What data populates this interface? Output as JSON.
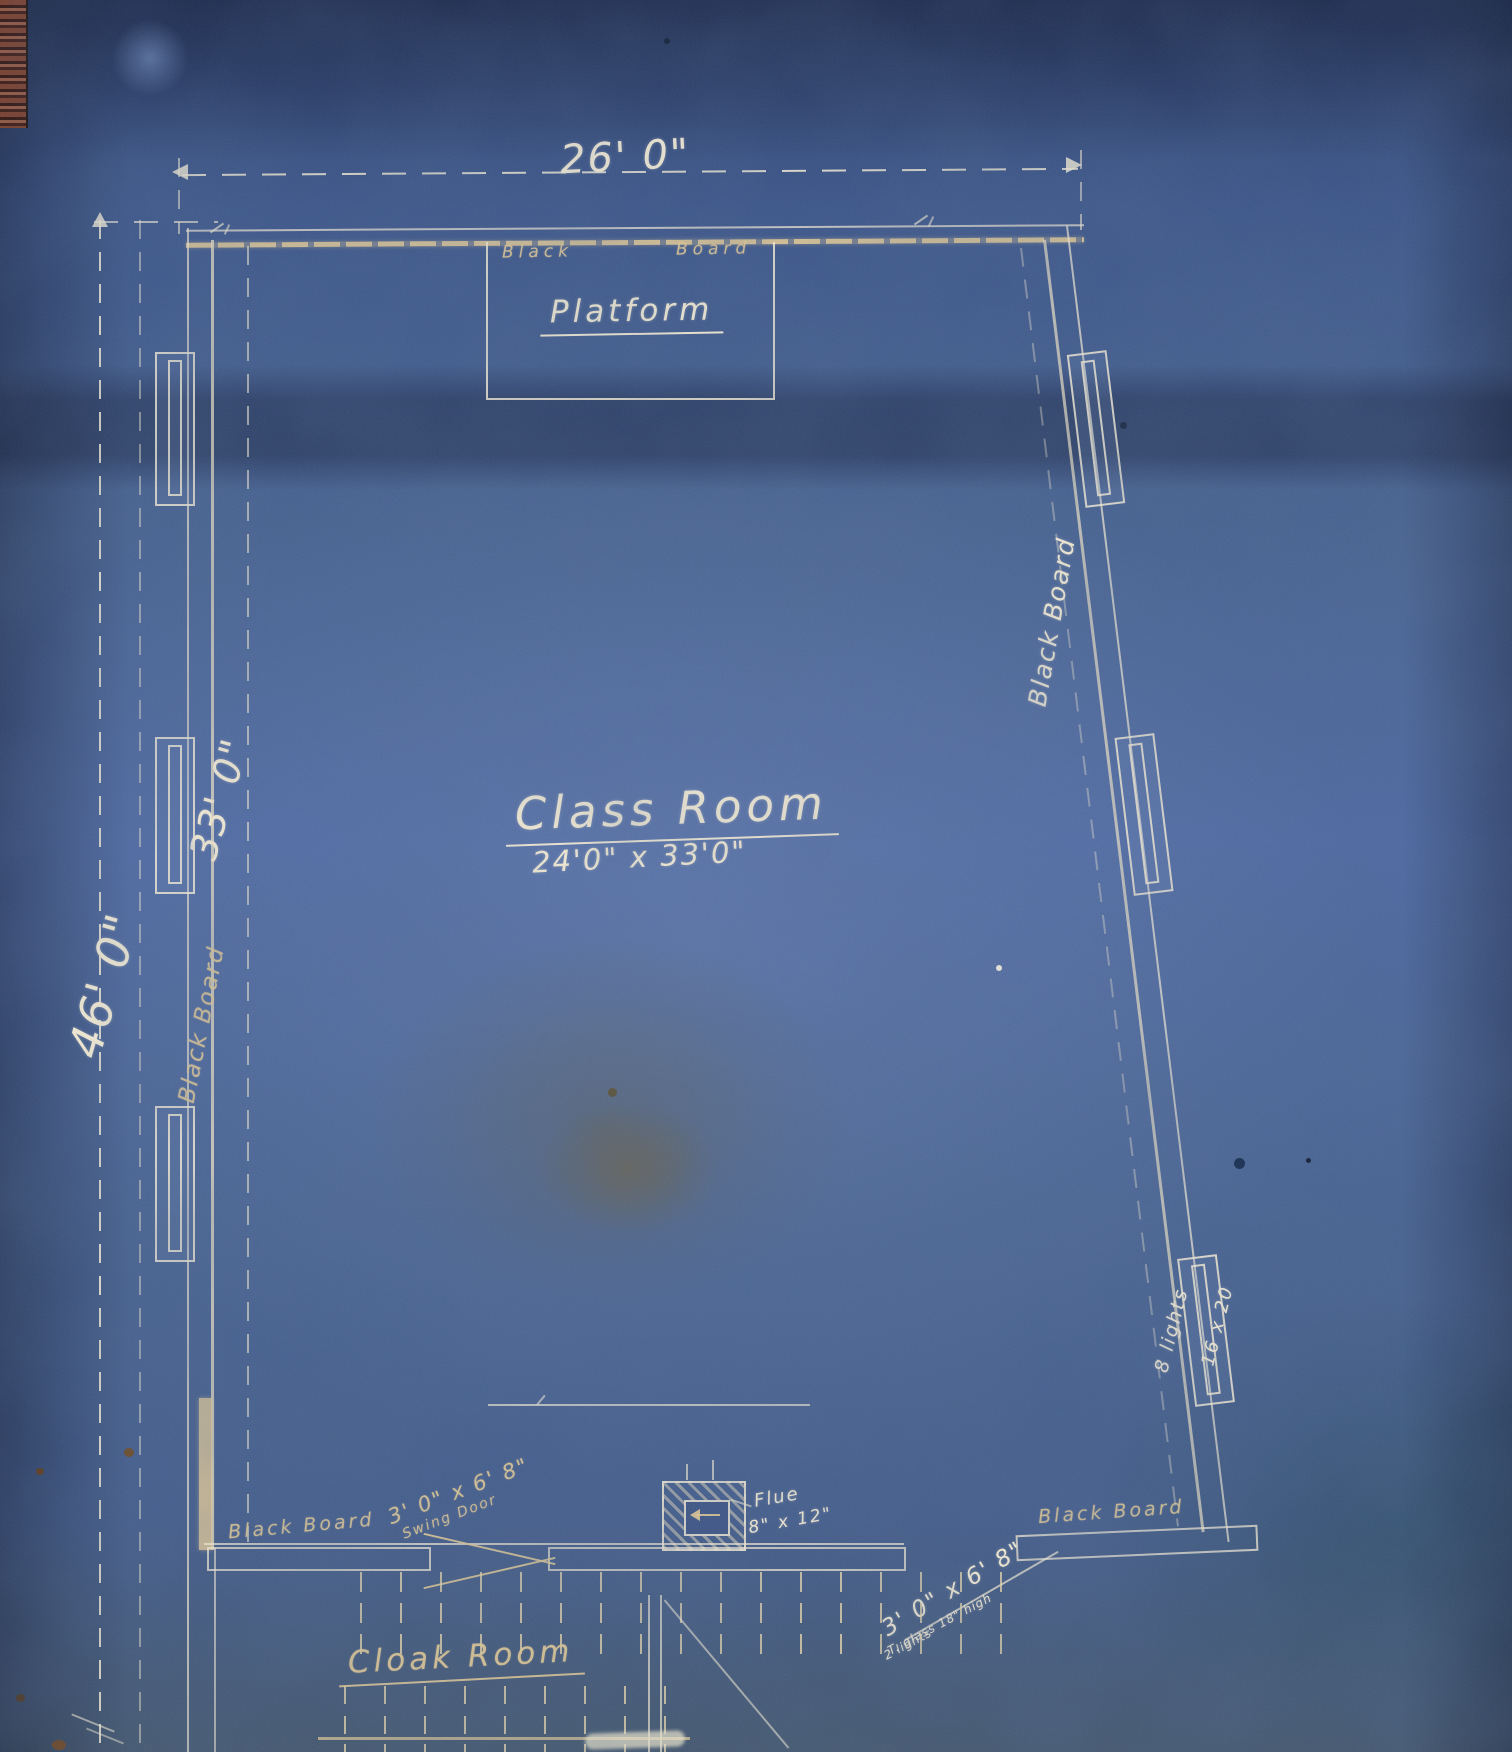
{
  "sheet": {
    "ink_color": "#f0e8d2",
    "paper_color": "#42598c"
  },
  "dims": {
    "width_overall": "26' 0\"",
    "height_overall": "46' 0\"",
    "height_classroom_wall": "33' 0\""
  },
  "rooms": {
    "classroom": {
      "name": "Class Room",
      "size": "24'0\" x 33'0\""
    },
    "platform": {
      "name": "Platform"
    },
    "cloak": {
      "name": "Cloak Room"
    }
  },
  "boards": {
    "top_word_black": "Black",
    "top_word_board": "Board",
    "left": "Black Board",
    "right": "Black Board",
    "bottom_left": "Black Board",
    "bottom_right": "Black Board"
  },
  "flue": {
    "name": "Flue",
    "size": "8\" x 12\""
  },
  "doors": {
    "swing": {
      "size": "3' 0\" x 6' 8\"",
      "label": "Swing Door"
    },
    "right": {
      "size": "3' 0\" x 6' 8\"",
      "note1": "T. glass 18\" high",
      "note2": "2 lights"
    }
  },
  "windows": {
    "right_lower": {
      "lights": "8 lights",
      "pane": "16 x 20"
    }
  }
}
